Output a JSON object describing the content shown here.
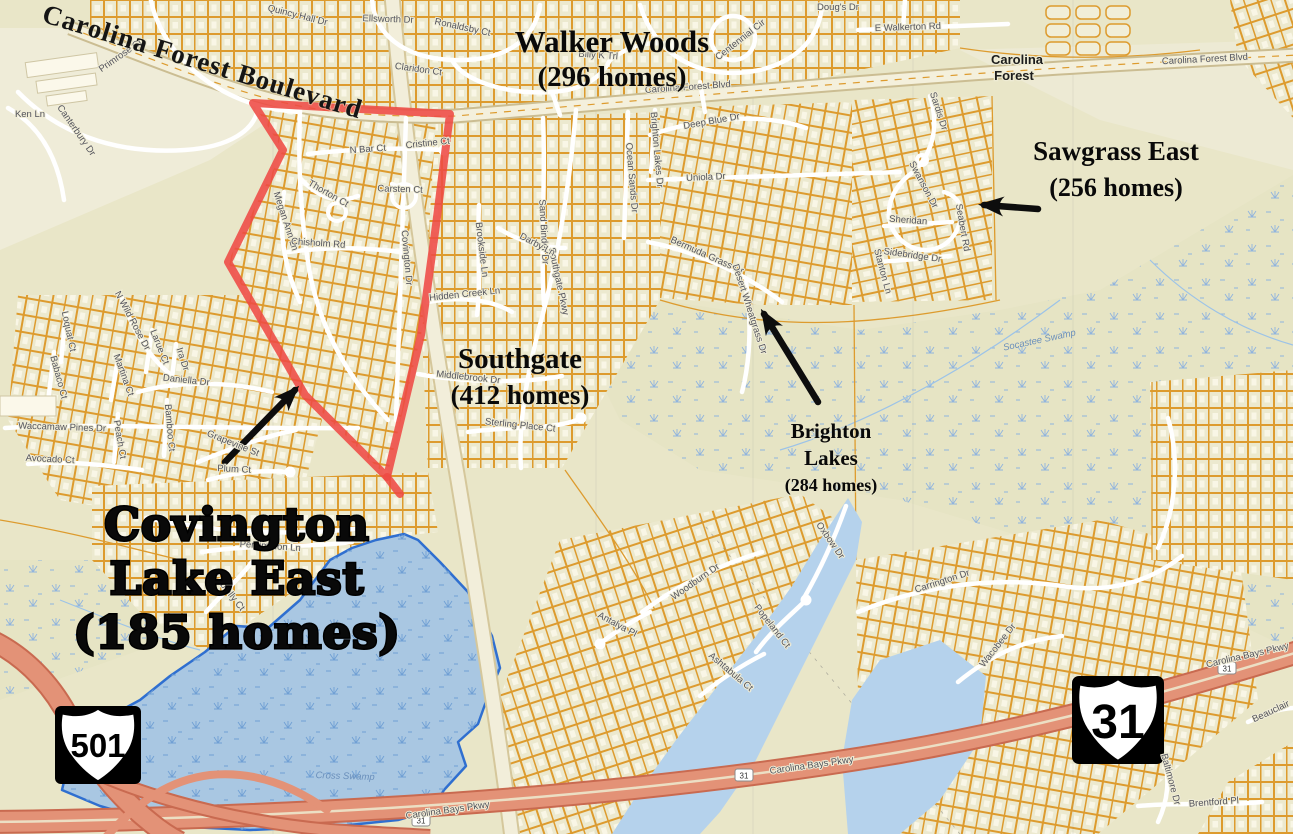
{
  "map": {
    "boulevard_label": "Carolina Forest Boulevard",
    "place_label": {
      "line1": "Carolina",
      "line2": "Forest"
    },
    "annotations": [
      {
        "id": "walker-woods",
        "x": 612,
        "y": 52,
        "lines": [
          {
            "t": "Walker Woods",
            "dy": 0,
            "s": 31
          },
          {
            "t": "(296 homes)",
            "dy": 34,
            "s": 29
          }
        ],
        "style": "serif"
      },
      {
        "id": "sawgrass-east",
        "x": 1116,
        "y": 160,
        "lines": [
          {
            "t": "Sawgrass East",
            "dy": 0,
            "s": 27
          },
          {
            "t": "(256 homes)",
            "dy": 36,
            "s": 26
          }
        ],
        "style": "serif"
      },
      {
        "id": "southgate",
        "x": 520,
        "y": 368,
        "lines": [
          {
            "t": "Southgate",
            "dy": 0,
            "s": 29
          },
          {
            "t": "(412 homes)",
            "dy": 36,
            "s": 27
          }
        ],
        "style": "serif"
      },
      {
        "id": "brighton-lakes",
        "x": 831,
        "y": 438,
        "lines": [
          {
            "t": "Brighton",
            "dy": 0,
            "s": 21
          },
          {
            "t": "Lakes",
            "dy": 27,
            "s": 21
          },
          {
            "t": "(284 homes)",
            "dy": 53,
            "s": 18
          }
        ],
        "style": "serif"
      },
      {
        "id": "covington-lake-east",
        "x": 237,
        "y": 540,
        "lines": [
          {
            "t": "Covington",
            "dy": 0,
            "s": 45
          },
          {
            "t": "Lake East",
            "dy": 54,
            "s": 45
          },
          {
            "t": "(185 homes)",
            "dy": 108,
            "s": 45
          }
        ],
        "style": "heavy"
      }
    ],
    "road_labels": [
      {
        "text": "Primrose Ct",
        "x": 122,
        "y": 58,
        "rot": -35
      },
      {
        "text": "Quincy Hall Dr",
        "x": 297,
        "y": 18,
        "rot": 14
      },
      {
        "text": "Ellsworth Dr",
        "x": 388,
        "y": 22,
        "rot": 2
      },
      {
        "text": "Ronaldsby Ct",
        "x": 462,
        "y": 30,
        "rot": 12
      },
      {
        "text": "Claridon Ct",
        "x": 418,
        "y": 72,
        "rot": 8
      },
      {
        "text": "Doug's Dr",
        "x": 838,
        "y": 10,
        "rot": 0
      },
      {
        "text": "Billy K Trl",
        "x": 598,
        "y": 58,
        "rot": 4
      },
      {
        "text": "Centennial Cir",
        "x": 742,
        "y": 42,
        "rot": -38
      },
      {
        "text": "E Walkerton Rd",
        "x": 908,
        "y": 30,
        "rot": -2
      },
      {
        "text": "Carolina Forest Blvd",
        "x": 688,
        "y": 90,
        "rot": -4
      },
      {
        "text": "Carolina Forest Blvd",
        "x": 1205,
        "y": 62,
        "rot": -3
      },
      {
        "text": "Sardis Dr",
        "x": 936,
        "y": 112,
        "rot": 72
      },
      {
        "text": "Swanson Dr",
        "x": 921,
        "y": 186,
        "rot": 62
      },
      {
        "text": "Sheridan",
        "x": 908,
        "y": 223,
        "rot": 4
      },
      {
        "text": "Seabert Rd",
        "x": 960,
        "y": 228,
        "rot": 80
      },
      {
        "text": "Sidebridge Dr",
        "x": 912,
        "y": 258,
        "rot": 8
      },
      {
        "text": "Stanton Ln",
        "x": 880,
        "y": 272,
        "rot": 75
      },
      {
        "text": "Deep Blue Dr",
        "x": 712,
        "y": 124,
        "rot": -10
      },
      {
        "text": "Uniola Dr",
        "x": 706,
        "y": 180,
        "rot": -3
      },
      {
        "text": "Ocean Sands Dr",
        "x": 629,
        "y": 178,
        "rot": 85
      },
      {
        "text": "Brighton Lakes Dr",
        "x": 654,
        "y": 150,
        "rot": 85
      },
      {
        "text": "Sand Binder Dr",
        "x": 541,
        "y": 232,
        "rot": 87
      },
      {
        "text": "Southgate Pkwy",
        "x": 556,
        "y": 282,
        "rot": 78
      },
      {
        "text": "Darby Ln",
        "x": 536,
        "y": 247,
        "rot": 28
      },
      {
        "text": "Brookside Ln",
        "x": 479,
        "y": 250,
        "rot": 83
      },
      {
        "text": "Hidden Creek Ln",
        "x": 465,
        "y": 297,
        "rot": -6
      },
      {
        "text": "Middlebrook Dr",
        "x": 468,
        "y": 380,
        "rot": 6
      },
      {
        "text": "Sterling Place Ct",
        "x": 520,
        "y": 428,
        "rot": 6
      },
      {
        "text": "Bermuda Grass Dr",
        "x": 706,
        "y": 258,
        "rot": 24
      },
      {
        "text": "Desert Wheatgrass Dr",
        "x": 747,
        "y": 310,
        "rot": 72
      },
      {
        "text": "N Bar Ct",
        "x": 368,
        "y": 152,
        "rot": -4
      },
      {
        "text": "Cristine Ct",
        "x": 428,
        "y": 146,
        "rot": -6
      },
      {
        "text": "Thorton Ct",
        "x": 327,
        "y": 196,
        "rot": 30
      },
      {
        "text": "Carsten Ct",
        "x": 400,
        "y": 192,
        "rot": 2
      },
      {
        "text": "Megan Ann Ln",
        "x": 283,
        "y": 222,
        "rot": 72
      },
      {
        "text": "Chisholm Rd",
        "x": 318,
        "y": 246,
        "rot": 4
      },
      {
        "text": "Covington Dr",
        "x": 404,
        "y": 258,
        "rot": 85
      },
      {
        "text": "Ken Ln",
        "x": 30,
        "y": 117,
        "rot": 0
      },
      {
        "text": "Canterbury Dr",
        "x": 74,
        "y": 132,
        "rot": 55
      },
      {
        "text": "Loquat Ct",
        "x": 66,
        "y": 332,
        "rot": 78
      },
      {
        "text": "Babaco Ct",
        "x": 56,
        "y": 378,
        "rot": 75
      },
      {
        "text": "N Wild Rose Dr",
        "x": 130,
        "y": 322,
        "rot": 62
      },
      {
        "text": "Larue Ct",
        "x": 157,
        "y": 348,
        "rot": 68
      },
      {
        "text": "Martina Ct",
        "x": 121,
        "y": 376,
        "rot": 70
      },
      {
        "text": "Ira Dr",
        "x": 180,
        "y": 360,
        "rot": 72
      },
      {
        "text": "Daniella Dr",
        "x": 186,
        "y": 383,
        "rot": 6
      },
      {
        "text": "Waccamaw Pines Dr",
        "x": 62,
        "y": 430,
        "rot": 2
      },
      {
        "text": "Peach Ct",
        "x": 117,
        "y": 440,
        "rot": 80
      },
      {
        "text": "Bamboo Ct",
        "x": 167,
        "y": 428,
        "rot": 85
      },
      {
        "text": "Avocado Ct",
        "x": 50,
        "y": 462,
        "rot": 3
      },
      {
        "text": "Grapevine St",
        "x": 232,
        "y": 446,
        "rot": 22
      },
      {
        "text": "Plum Ct",
        "x": 234,
        "y": 472,
        "rot": 3
      },
      {
        "text": "Persimmon Ln",
        "x": 270,
        "y": 549,
        "rot": 4
      },
      {
        "text": "Loblolly Ct",
        "x": 227,
        "y": 594,
        "rot": 52
      },
      {
        "text": "Woodburn Dr",
        "x": 697,
        "y": 584,
        "rot": -35
      },
      {
        "text": "Oxbow Dr",
        "x": 828,
        "y": 542,
        "rot": 55
      },
      {
        "text": "Popeland Ct",
        "x": 770,
        "y": 628,
        "rot": 52
      },
      {
        "text": "Ashtabula Ct",
        "x": 729,
        "y": 674,
        "rot": 40
      },
      {
        "text": "Antalya Pl",
        "x": 616,
        "y": 627,
        "rot": 28
      },
      {
        "text": "Carrington Dr",
        "x": 943,
        "y": 584,
        "rot": -18
      },
      {
        "text": "Wacobee Dr",
        "x": 1000,
        "y": 647,
        "rot": -52
      },
      {
        "text": "Brentford Pl",
        "x": 1214,
        "y": 805,
        "rot": -4
      },
      {
        "text": "Baltimore Dr",
        "x": 1168,
        "y": 780,
        "rot": 75
      },
      {
        "text": "Beauclair",
        "x": 1272,
        "y": 714,
        "rot": -25
      },
      {
        "text": "Carolina Bays Pkwy",
        "x": 448,
        "y": 813,
        "rot": -8
      },
      {
        "text": "Carolina Bays Pkwy",
        "x": 812,
        "y": 768,
        "rot": -8
      },
      {
        "text": "Carolina Bays Pkwy",
        "x": 1248,
        "y": 658,
        "rot": -13
      },
      {
        "text": "Cross Swamp",
        "x": 345,
        "y": 779,
        "rot": 2,
        "water": true
      },
      {
        "text": "Socastee Swamp",
        "x": 1040,
        "y": 343,
        "rot": -12,
        "water": true
      }
    ],
    "shields": {
      "us501": {
        "number": "501"
      },
      "us31": {
        "number": "31"
      }
    },
    "route_markers": [
      {
        "text": "31",
        "x": 421,
        "y": 822
      },
      {
        "text": "31",
        "x": 744,
        "y": 777
      },
      {
        "text": "31",
        "x": 1227,
        "y": 670
      }
    ],
    "colors": {
      "background": "#e9e6c8",
      "parcel_line": "#dd9b2e",
      "road_white": "#ffffff",
      "highway_fill": "#e39277",
      "highway_edge": "#c96a50",
      "boundary_red": "#ee4a44",
      "water_fill": "#a9c7e2",
      "water_edge": "#2f6fd0",
      "label_gray": "#53535c"
    }
  }
}
